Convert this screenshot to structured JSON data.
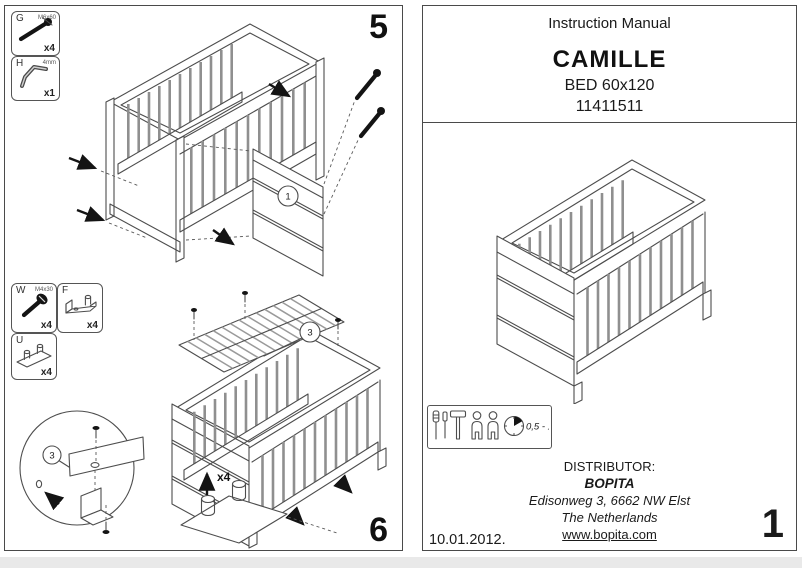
{
  "left_sheet": {
    "step_top_label": "5",
    "step_bottom_label": "6",
    "hardware_boxes": [
      {
        "key": "G",
        "spec": "M6x60",
        "qty": "x4",
        "icon": "bolt-icon"
      },
      {
        "key": "H",
        "spec": "4mm",
        "qty": "x1",
        "icon": "allen-key-icon"
      },
      {
        "key": "W",
        "spec": "M4x30",
        "qty": "x4",
        "icon": "screw-icon"
      },
      {
        "key": "F",
        "spec": "",
        "qty": "x4",
        "icon": "angle-bracket-icon"
      },
      {
        "key": "U",
        "spec": "",
        "qty": "x4",
        "icon": "double-peg-bracket-icon"
      }
    ],
    "step5": {
      "part_callout": "1"
    },
    "step6": {
      "part_callout": "3",
      "detail_callout": "3",
      "feet_qty_label": "x4"
    }
  },
  "right_sheet": {
    "title": "Instruction Manual",
    "product_name": "CAMILLE",
    "product_type": "BED 60x120",
    "article_number": "11411511",
    "info_box": {
      "duration_label": "0,5 - 1",
      "icons": [
        "screwdriver-icon",
        "screwdriver-icon",
        "hammer-icon",
        "person-icon",
        "person-icon",
        "clock-icon"
      ]
    },
    "distributor": {
      "heading": "DISTRIBUTOR:",
      "name": "BOPITA",
      "address_line1": "Edisonweg 3, 6662 NW Elst",
      "address_line2": "The Netherlands",
      "website": "www.bopita.com"
    },
    "date_label": "10.01.2012.",
    "page_number": "1"
  },
  "colors": {
    "line": "#4d4d4d",
    "ink": "#141414",
    "paper": "#ffffff"
  }
}
